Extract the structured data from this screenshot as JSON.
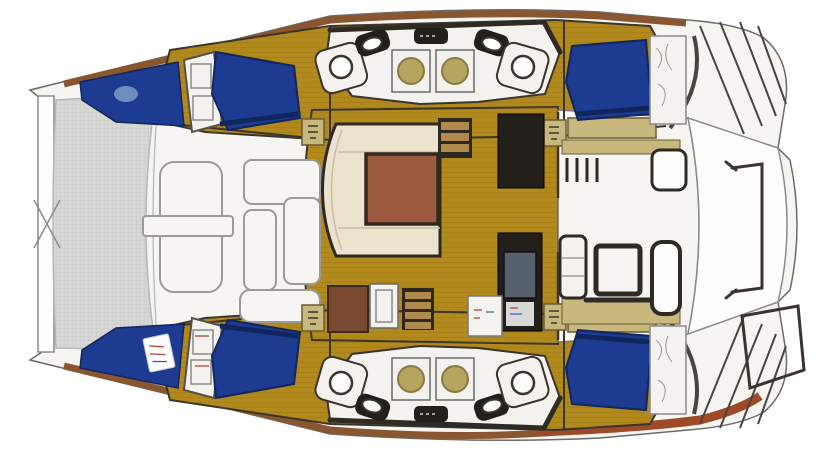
{
  "figure": {
    "kind": "floor-plan-illustration",
    "subject": "catamaran-yacht-deck-layout",
    "orientation": "bow-left",
    "layout": "4-cabin-2-head",
    "areas": {
      "bow": [
        "crossbeam",
        "trampoline",
        "foredeck-lounge"
      ],
      "starboard_hull": [
        "forward-cabin",
        "head-with-shower",
        "aft-cabin"
      ],
      "center": [
        "salon-settee",
        "salon-table",
        "companionway-steps",
        "galley-cabinets"
      ],
      "port_hull": [
        "forward-cabin",
        "head-with-shower",
        "aft-cabin"
      ],
      "stern": [
        "cockpit-table",
        "cockpit-benches",
        "transom-steps",
        "dinghy-davits"
      ]
    }
  },
  "colors": {
    "background": "#ffffff",
    "hull_white": "#f6f5f2",
    "fixture_white": "#f4f2ee",
    "bright_white": "#fdfdfc",
    "floor_gold": "#b2891c",
    "berth_blue": "#1d3b90",
    "berth_blue_dark": "#10265c",
    "pillow_blue": "#7e9cc4",
    "cream": "#ebe3cd",
    "table_brown": "#9c5a3e",
    "khaki": "#c9b87d",
    "dark_cabinet": "#231f1b",
    "basin_tan": "#b5a55e",
    "trampoline_gray": "#d7d7d5",
    "wood_brown": "#8a5630",
    "wood_red": "#9d4a28",
    "tv_gray": "#56616d",
    "step_tread": "#b08a4a",
    "cabinet_brown": "#7a4a30",
    "pic_gray": "#d8d8d6"
  }
}
